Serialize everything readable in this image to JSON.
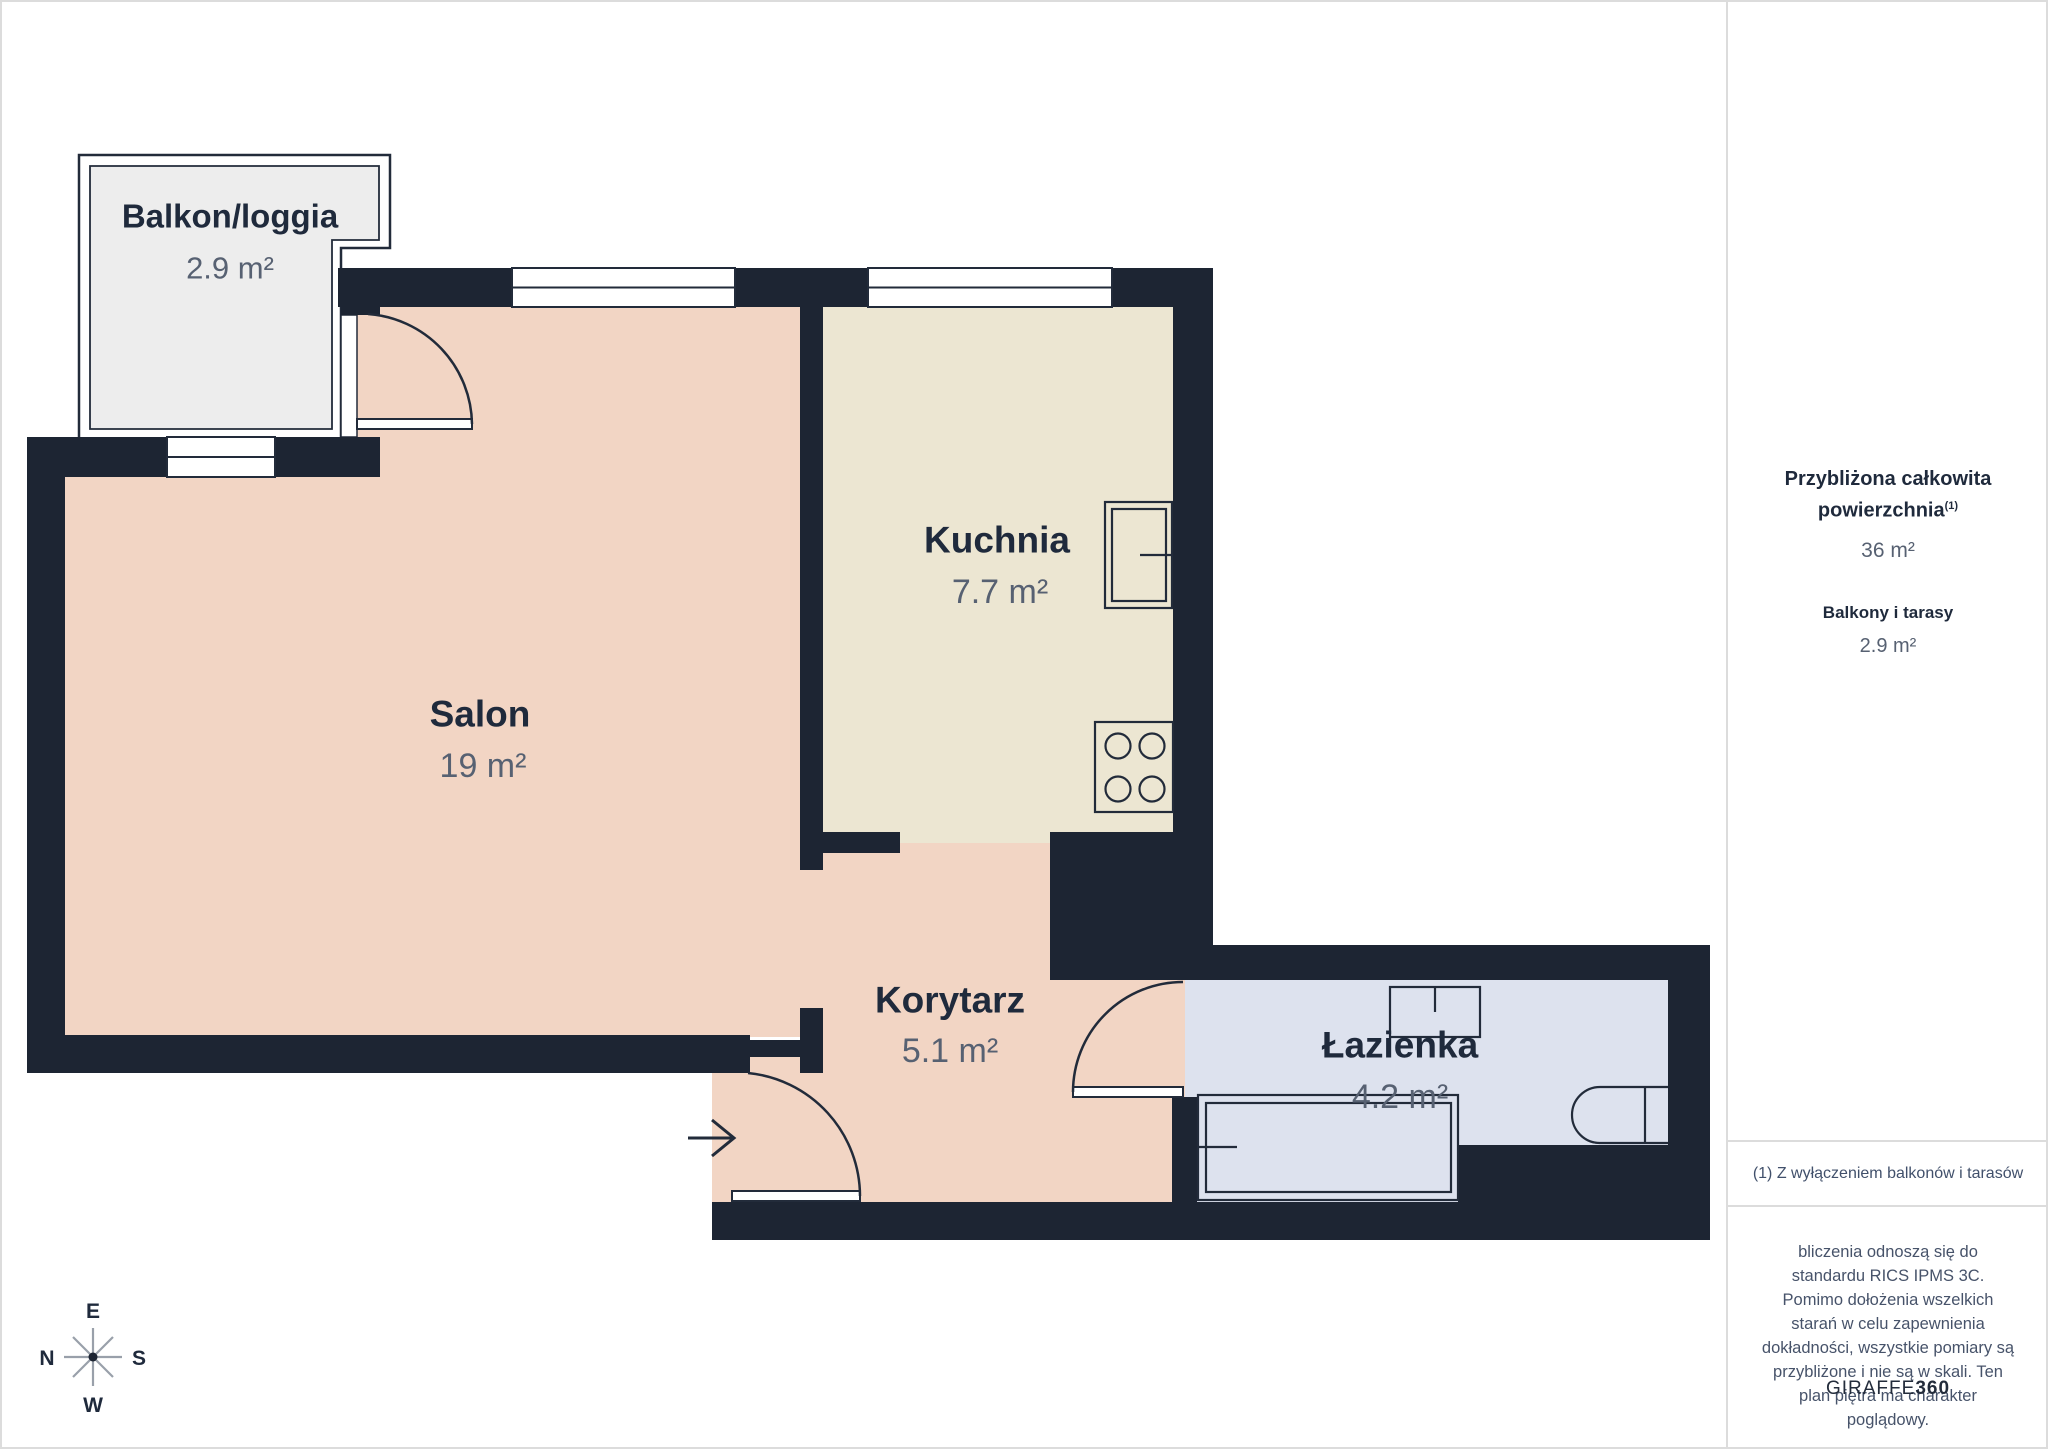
{
  "rooms": [
    {
      "name": "Balkon/loggia",
      "area": "2.9 m²"
    },
    {
      "name": "Salon",
      "area": "19 m²"
    },
    {
      "name": "Kuchnia",
      "area": "7.7 m²"
    },
    {
      "name": "Korytarz",
      "area": "5.1 m²"
    },
    {
      "name": "Łazienka",
      "area": "4.2 m²"
    }
  ],
  "sidebar": {
    "title_line1": "Przybliżona całkowita",
    "title_line2": "powierzchnia",
    "title_sup": "(1)",
    "total_area": "36 m²",
    "balconies_label": "Balkony i tarasy",
    "balconies_area": "2.9 m²",
    "footnote": "(1) Z wyłączeniem balkonów i tarasów",
    "disclaimer": "bliczenia odnoszą się do standardu RICS IPMS 3C. Pomimo dołożenia wszelkich starań w celu zapewnienia dokładności, wszystkie pomiary są przybliżone i nie są w skali. Ten plan piętra ma charakter poglądowy.",
    "logo_text": "GIRAFFE",
    "logo_suffix": "360"
  },
  "compass": {
    "top": "E",
    "left": "N",
    "right": "S",
    "bottom": "W"
  },
  "fixtures": [
    "kitchen-sink",
    "stove",
    "washbasin",
    "toilet",
    "bathtub"
  ],
  "colors": {
    "wall": "#1d2533",
    "floor_salon": "#f2d5c4",
    "floor_kitchen": "#ece6d2",
    "floor_bathroom": "#dde2ee",
    "floor_balcony": "#ededed",
    "line_dark": "#222b3a",
    "white": "#ffffff",
    "text_dark": "#1f2a3c",
    "text_gray": "#576172",
    "compass_line": "#99a0aa",
    "border_gray": "#dcdcdc"
  }
}
